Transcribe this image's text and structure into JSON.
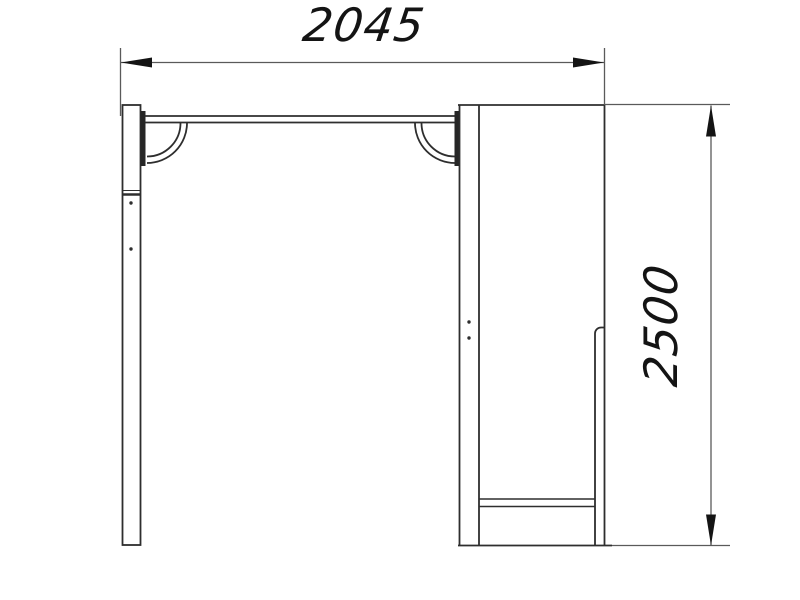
{
  "colors": {
    "background": "#ffffff",
    "drawing_line": "#2e2e2e",
    "dimension_line": "#5a5a5a",
    "arrow_and_text": "#141414"
  },
  "dimensions": {
    "width_label": "2045",
    "height_label": "2500"
  }
}
